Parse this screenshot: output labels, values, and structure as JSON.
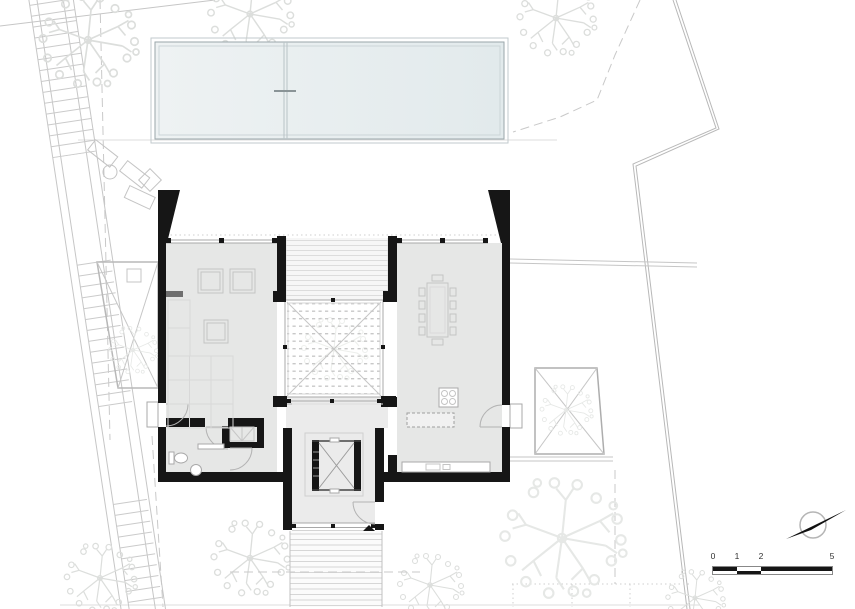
{
  "scale_bar": {
    "labels": [
      "0",
      "1",
      "2",
      "5"
    ]
  },
  "colors": {
    "wall": "#161616",
    "floor": "#e6e7e6",
    "floor_light": "#ebebeb",
    "pool_left": "#eef2f3",
    "pool_right": "#e2eaec",
    "pool_border": "#9aa6aa",
    "line_light": "#c6c6c6",
    "line_mid": "#9c9c9c",
    "tree": "#dcdedc",
    "dash": "#c9c9c9"
  },
  "features": [
    "swimming-pool",
    "main-building",
    "central-courtyard",
    "left-courtyard",
    "right-courtyard",
    "perimeter-stair",
    "entry-walkway",
    "trees",
    "north-arrow",
    "scale-bar"
  ]
}
